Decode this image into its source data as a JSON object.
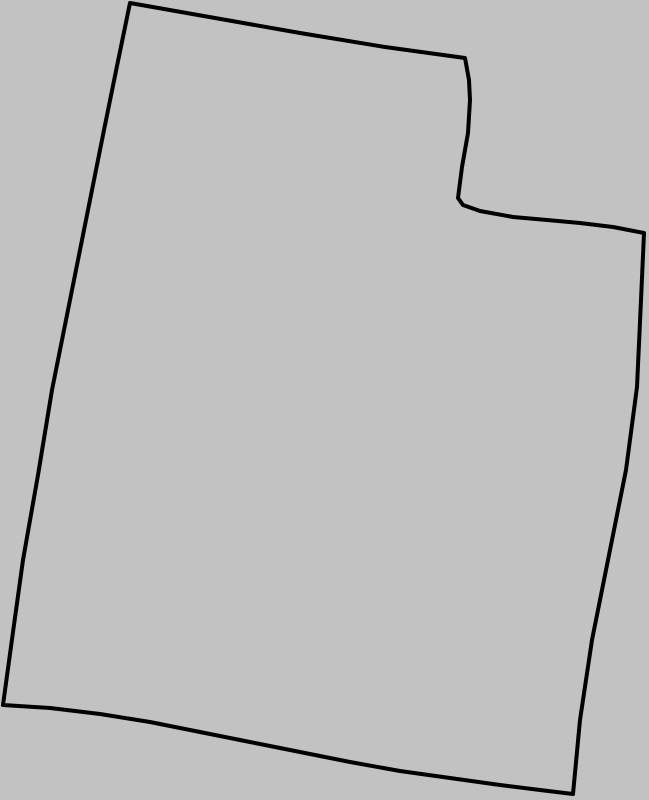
{
  "canvas": {
    "width": 649,
    "height": 800,
    "background_color": "#c2c2c2"
  },
  "map": {
    "name": "utah-state-outline",
    "stroke_color": "#000000",
    "stroke_width": 4,
    "fill": "none",
    "outline_points": [
      [
        130,
        3
      ],
      [
        215,
        18
      ],
      [
        300,
        33
      ],
      [
        385,
        47
      ],
      [
        465,
        58
      ],
      [
        469,
        80
      ],
      [
        470,
        100
      ],
      [
        468,
        133
      ],
      [
        462,
        167
      ],
      [
        458,
        198
      ],
      [
        463,
        205
      ],
      [
        480,
        211
      ],
      [
        513,
        217
      ],
      [
        547,
        220
      ],
      [
        580,
        223
      ],
      [
        613,
        227
      ],
      [
        644,
        233
      ],
      [
        641,
        300
      ],
      [
        637,
        387
      ],
      [
        626,
        470
      ],
      [
        612,
        540
      ],
      [
        592,
        640
      ],
      [
        580,
        720
      ],
      [
        573,
        794
      ],
      [
        540,
        790
      ],
      [
        500,
        785
      ],
      [
        450,
        778
      ],
      [
        400,
        771
      ],
      [
        350,
        762
      ],
      [
        300,
        752
      ],
      [
        250,
        742
      ],
      [
        200,
        732
      ],
      [
        150,
        722
      ],
      [
        100,
        714
      ],
      [
        50,
        708
      ],
      [
        3,
        705
      ],
      [
        13,
        632
      ],
      [
        23,
        560
      ],
      [
        38,
        475
      ],
      [
        52,
        390
      ],
      [
        65,
        325
      ],
      [
        78,
        260
      ],
      [
        91,
        195
      ],
      [
        104,
        130
      ],
      [
        117,
        66
      ]
    ]
  }
}
